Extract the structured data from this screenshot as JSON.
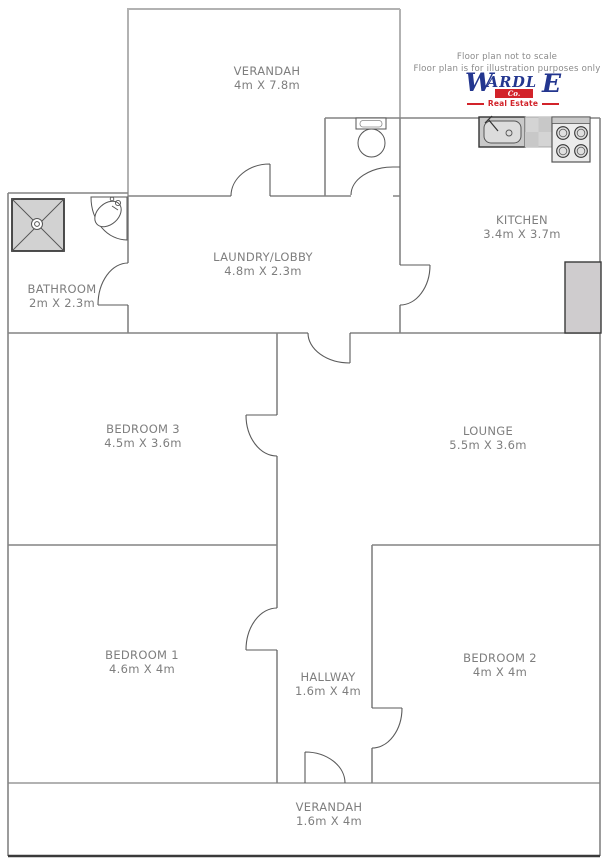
{
  "disclaimer": {
    "line1": "Floor plan not to scale",
    "line2": "Floor plan is for illustration purposes only"
  },
  "logo": {
    "w": "W",
    "ardl": "ARDL",
    "e": "E",
    "co": "Co.",
    "tagline": "Real Estate"
  },
  "rooms": [
    {
      "name": "VERANDAH",
      "dims": "4m X 7.8m"
    },
    {
      "name": "KITCHEN",
      "dims": "3.4m X 3.7m"
    },
    {
      "name": "LAUNDRY/LOBBY",
      "dims": "4.8m X 2.3m"
    },
    {
      "name": "BATHROOM",
      "dims": "2m X 2.3m"
    },
    {
      "name": "BEDROOM 3",
      "dims": "4.5m X 3.6m"
    },
    {
      "name": "LOUNGE",
      "dims": "5.5m X 3.6m"
    },
    {
      "name": "BEDROOM 1",
      "dims": "4.6m X 4m"
    },
    {
      "name": "HALLWAY",
      "dims": "1.6m X 4m"
    },
    {
      "name": "BEDROOM 2",
      "dims": "4m X 4m"
    },
    {
      "name": "VERANDAH",
      "dims": "1.6m X 4m"
    }
  ],
  "fixtures": [
    "shower",
    "corner-basin",
    "toilet",
    "kitchen-sink",
    "counter",
    "stove",
    "pantry-cupboard"
  ],
  "colors": {
    "wall": "#848484",
    "verandah_wall": "#b2b2b2",
    "base_wall": "#3a3a3a",
    "door": "#5a5a5a",
    "label": "#7e7e7e",
    "logo_navy": "#23368f",
    "logo_red": "#d2232a",
    "fixture_fill": "#d2d2d2"
  }
}
